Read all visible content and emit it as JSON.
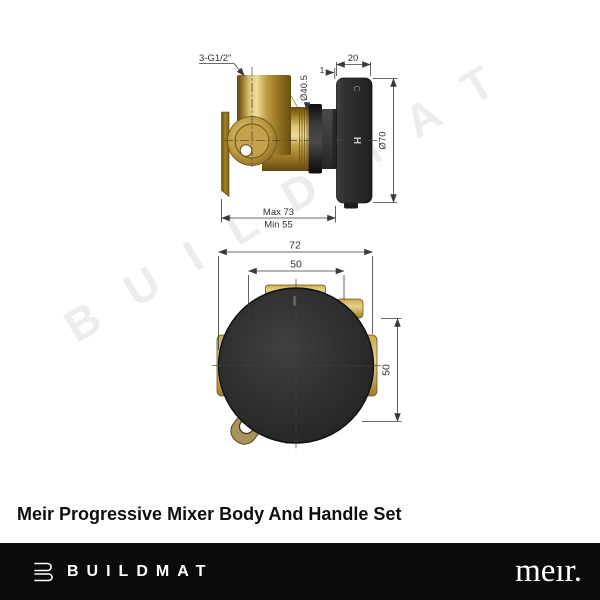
{
  "watermark": {
    "text": "BUILDMAT",
    "color": "#ececec"
  },
  "title": "Meir Progressive Mixer Body And Handle Set",
  "top_view": {
    "thread_label": "3-G1/2\"",
    "handle_depth_mm": "20",
    "face_offset_mm": "1",
    "body_diameter": "Ø40.5",
    "handle_diameter": "Ø70",
    "rough_in_max": "Max 73",
    "rough_in_min": "Min 55",
    "cold_marker": "C",
    "hot_marker": "H"
  },
  "front_view": {
    "overall_width_mm": "72",
    "horizontal_centres_mm": "50",
    "vertical_centres_mm": "50"
  },
  "footer": {
    "brand": "BUILDMAT",
    "manufacturer_logo": "meır.",
    "background": "#0b0b0b"
  },
  "colors": {
    "brass": "#b3913f",
    "brass_highlight": "#eedd9b",
    "matte_black": "#2c2c2c",
    "drawing_line": "#3a3a3a",
    "watermark": "#ececec",
    "footer_bg": "#0b0b0b"
  }
}
